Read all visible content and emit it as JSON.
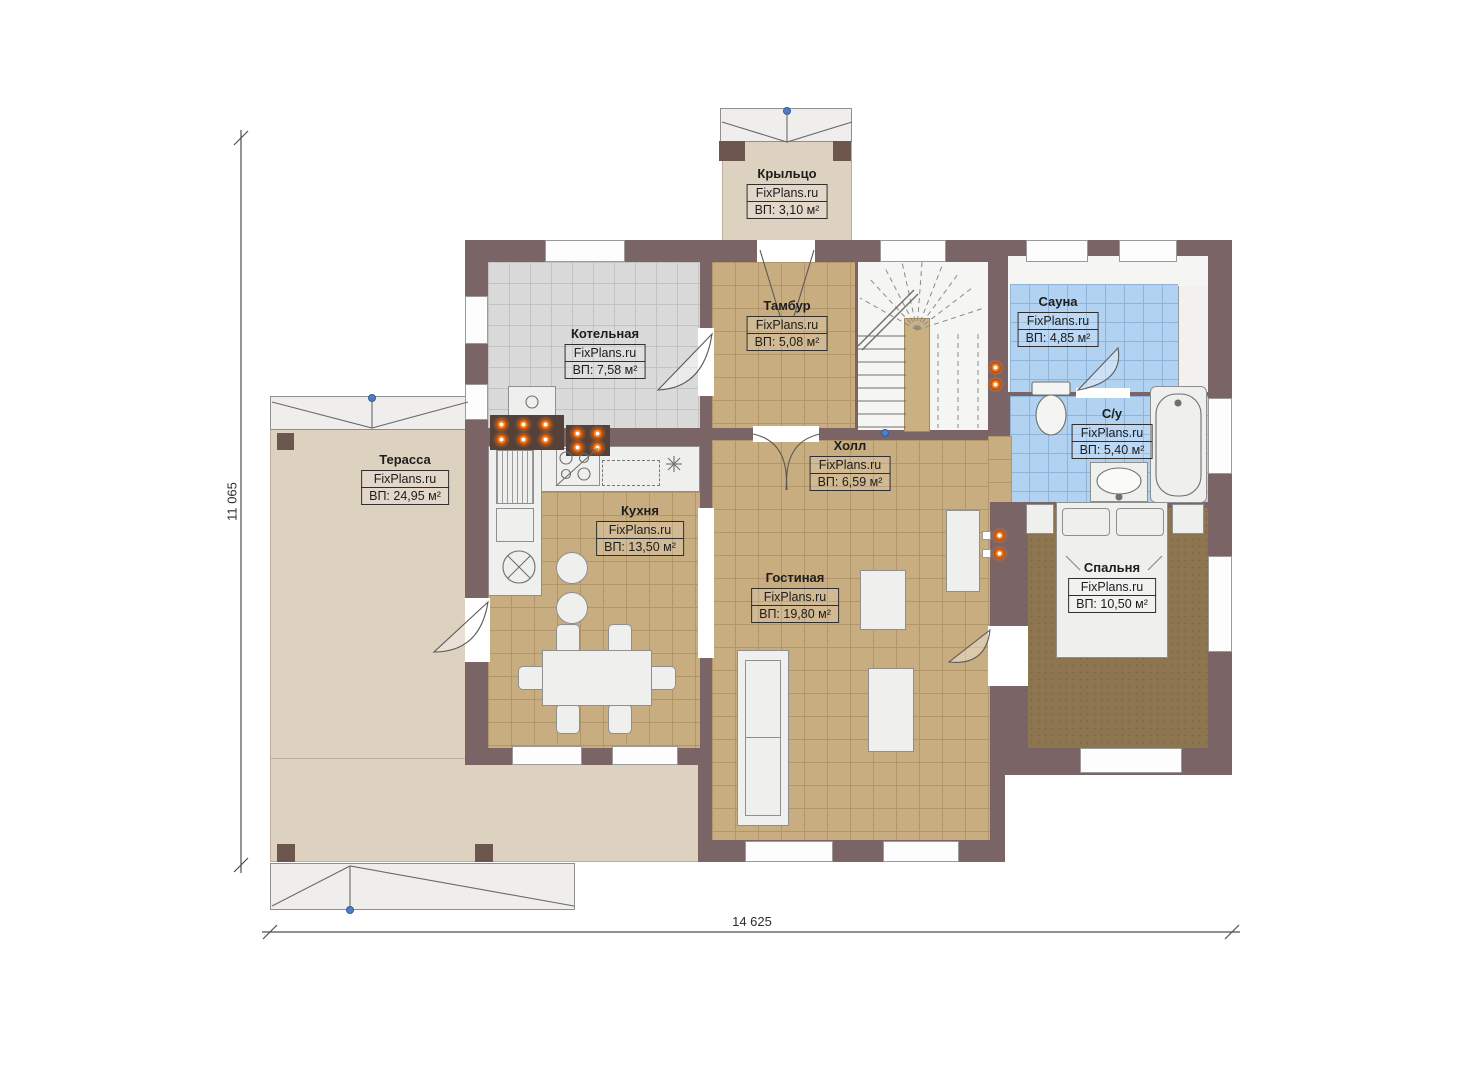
{
  "title": "План первого этажа",
  "watermark": "FixPlans.ru",
  "dimensions": {
    "width": "14 625",
    "height": "11 065"
  },
  "rooms": [
    {
      "id": "porch",
      "name": "Крыльцо",
      "brand": "FixPlans.ru",
      "area": "ВП: 3,10 м²"
    },
    {
      "id": "boiler",
      "name": "Котельная",
      "brand": "FixPlans.ru",
      "area": "ВП: 7,58 м²"
    },
    {
      "id": "vestibule",
      "name": "Тамбур",
      "brand": "FixPlans.ru",
      "area": "ВП: 5,08 м²"
    },
    {
      "id": "sauna",
      "name": "Сауна",
      "brand": "FixPlans.ru",
      "area": "ВП: 4,85 м²"
    },
    {
      "id": "bathroom",
      "name": "С/у",
      "brand": "FixPlans.ru",
      "area": "ВП: 5,40 м²"
    },
    {
      "id": "terrace",
      "name": "Терасса",
      "brand": "FixPlans.ru",
      "area": "ВП: 24,95 м²"
    },
    {
      "id": "kitchen",
      "name": "Кухня",
      "brand": "FixPlans.ru",
      "area": "ВП: 13,50 м²"
    },
    {
      "id": "hall",
      "name": "Холл",
      "brand": "FixPlans.ru",
      "area": "ВП: 6,59 м²"
    },
    {
      "id": "living",
      "name": "Гостиная",
      "brand": "FixPlans.ru",
      "area": "ВП: 19,80 м²"
    },
    {
      "id": "bedroom",
      "name": "Спальня",
      "brand": "FixPlans.ru",
      "area": "ВП: 10,50 м²"
    }
  ],
  "colors": {
    "wall": "#7a6466",
    "wall_dark": "#54413a",
    "floor_tan": "#c8ad80",
    "floor_gray": "#dadada",
    "floor_blue": "#b2d2f2",
    "carpet": "#8d764f",
    "slab": "#ddd1c0",
    "accent_orange": "#f07c20",
    "node_blue": "#4d7fca"
  }
}
